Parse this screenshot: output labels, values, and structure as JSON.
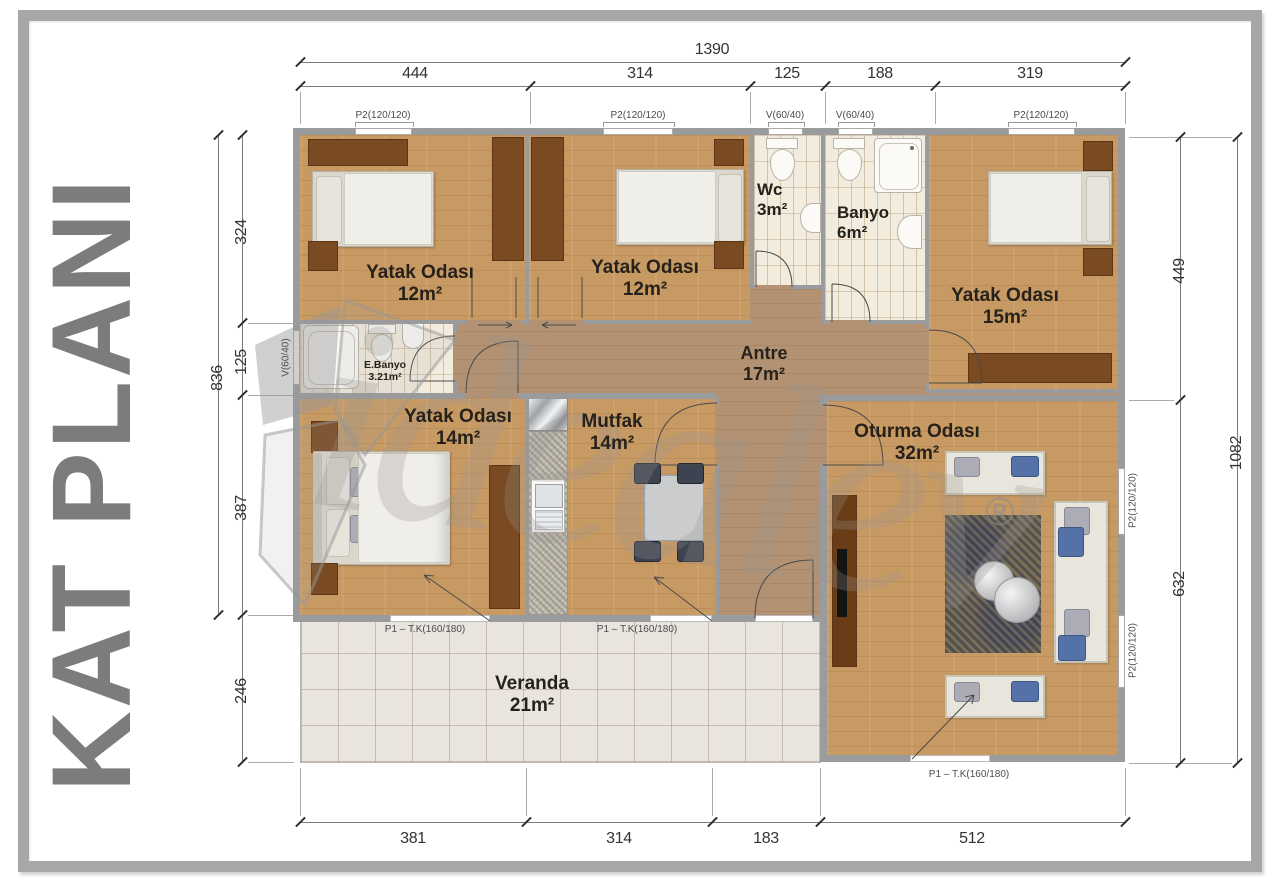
{
  "title": "KAT PLANI",
  "watermark": {
    "brand": "idealev",
    "registered": "®"
  },
  "rooms": [
    {
      "name": "Yatak Odası",
      "area": "12m²"
    },
    {
      "name": "Yatak Odası",
      "area": "12m²"
    },
    {
      "name": "Wc",
      "area": "3m²"
    },
    {
      "name": "Banyo",
      "area": "6m²"
    },
    {
      "name": "Yatak Odası",
      "area": "15m²"
    },
    {
      "name": "E.Banyo",
      "area": "3.21m²"
    },
    {
      "name": "Antre",
      "area": "17m²"
    },
    {
      "name": "Yatak Odası",
      "area": "14m²"
    },
    {
      "name": "Mutfak",
      "area": "14m²"
    },
    {
      "name": "Oturma Odası",
      "area": "32m²"
    },
    {
      "name": "Veranda",
      "area": "21m²"
    }
  ],
  "dimensions": {
    "top": {
      "total": "1390",
      "segments": [
        "444",
        "314",
        "125",
        "188",
        "319"
      ]
    },
    "left": {
      "outer": "836",
      "segments": [
        "324",
        "125",
        "387",
        "246"
      ]
    },
    "right": {
      "outer": "1082",
      "segments": [
        "449",
        "632"
      ]
    },
    "bottom": {
      "segments": [
        "381",
        "314",
        "183",
        "512"
      ]
    }
  },
  "openings": {
    "top_windows": [
      "P2(120/120)",
      "P2(120/120)",
      "V(60/40)",
      "V(60/40)",
      "P2(120/120)"
    ],
    "left_window": "V(60/40)",
    "right_windows": [
      "P2(120/120)",
      "P2(120/120)"
    ],
    "doors": [
      "P1 – T.K(160/180)",
      "P1 – T.K(160/180)",
      "P1 – T.K(160/180)"
    ]
  },
  "colors": {
    "wood_floor": "#c89a63",
    "hall_floor": "#b29272",
    "wall": "#9a9b9d",
    "bath_tile": "#f2ecdf",
    "veranda_tile": "#e9e5de",
    "wardrobe": "#7a4a23",
    "title_gray": "#7c7c7c",
    "cushion_blue": "#5472a8"
  }
}
